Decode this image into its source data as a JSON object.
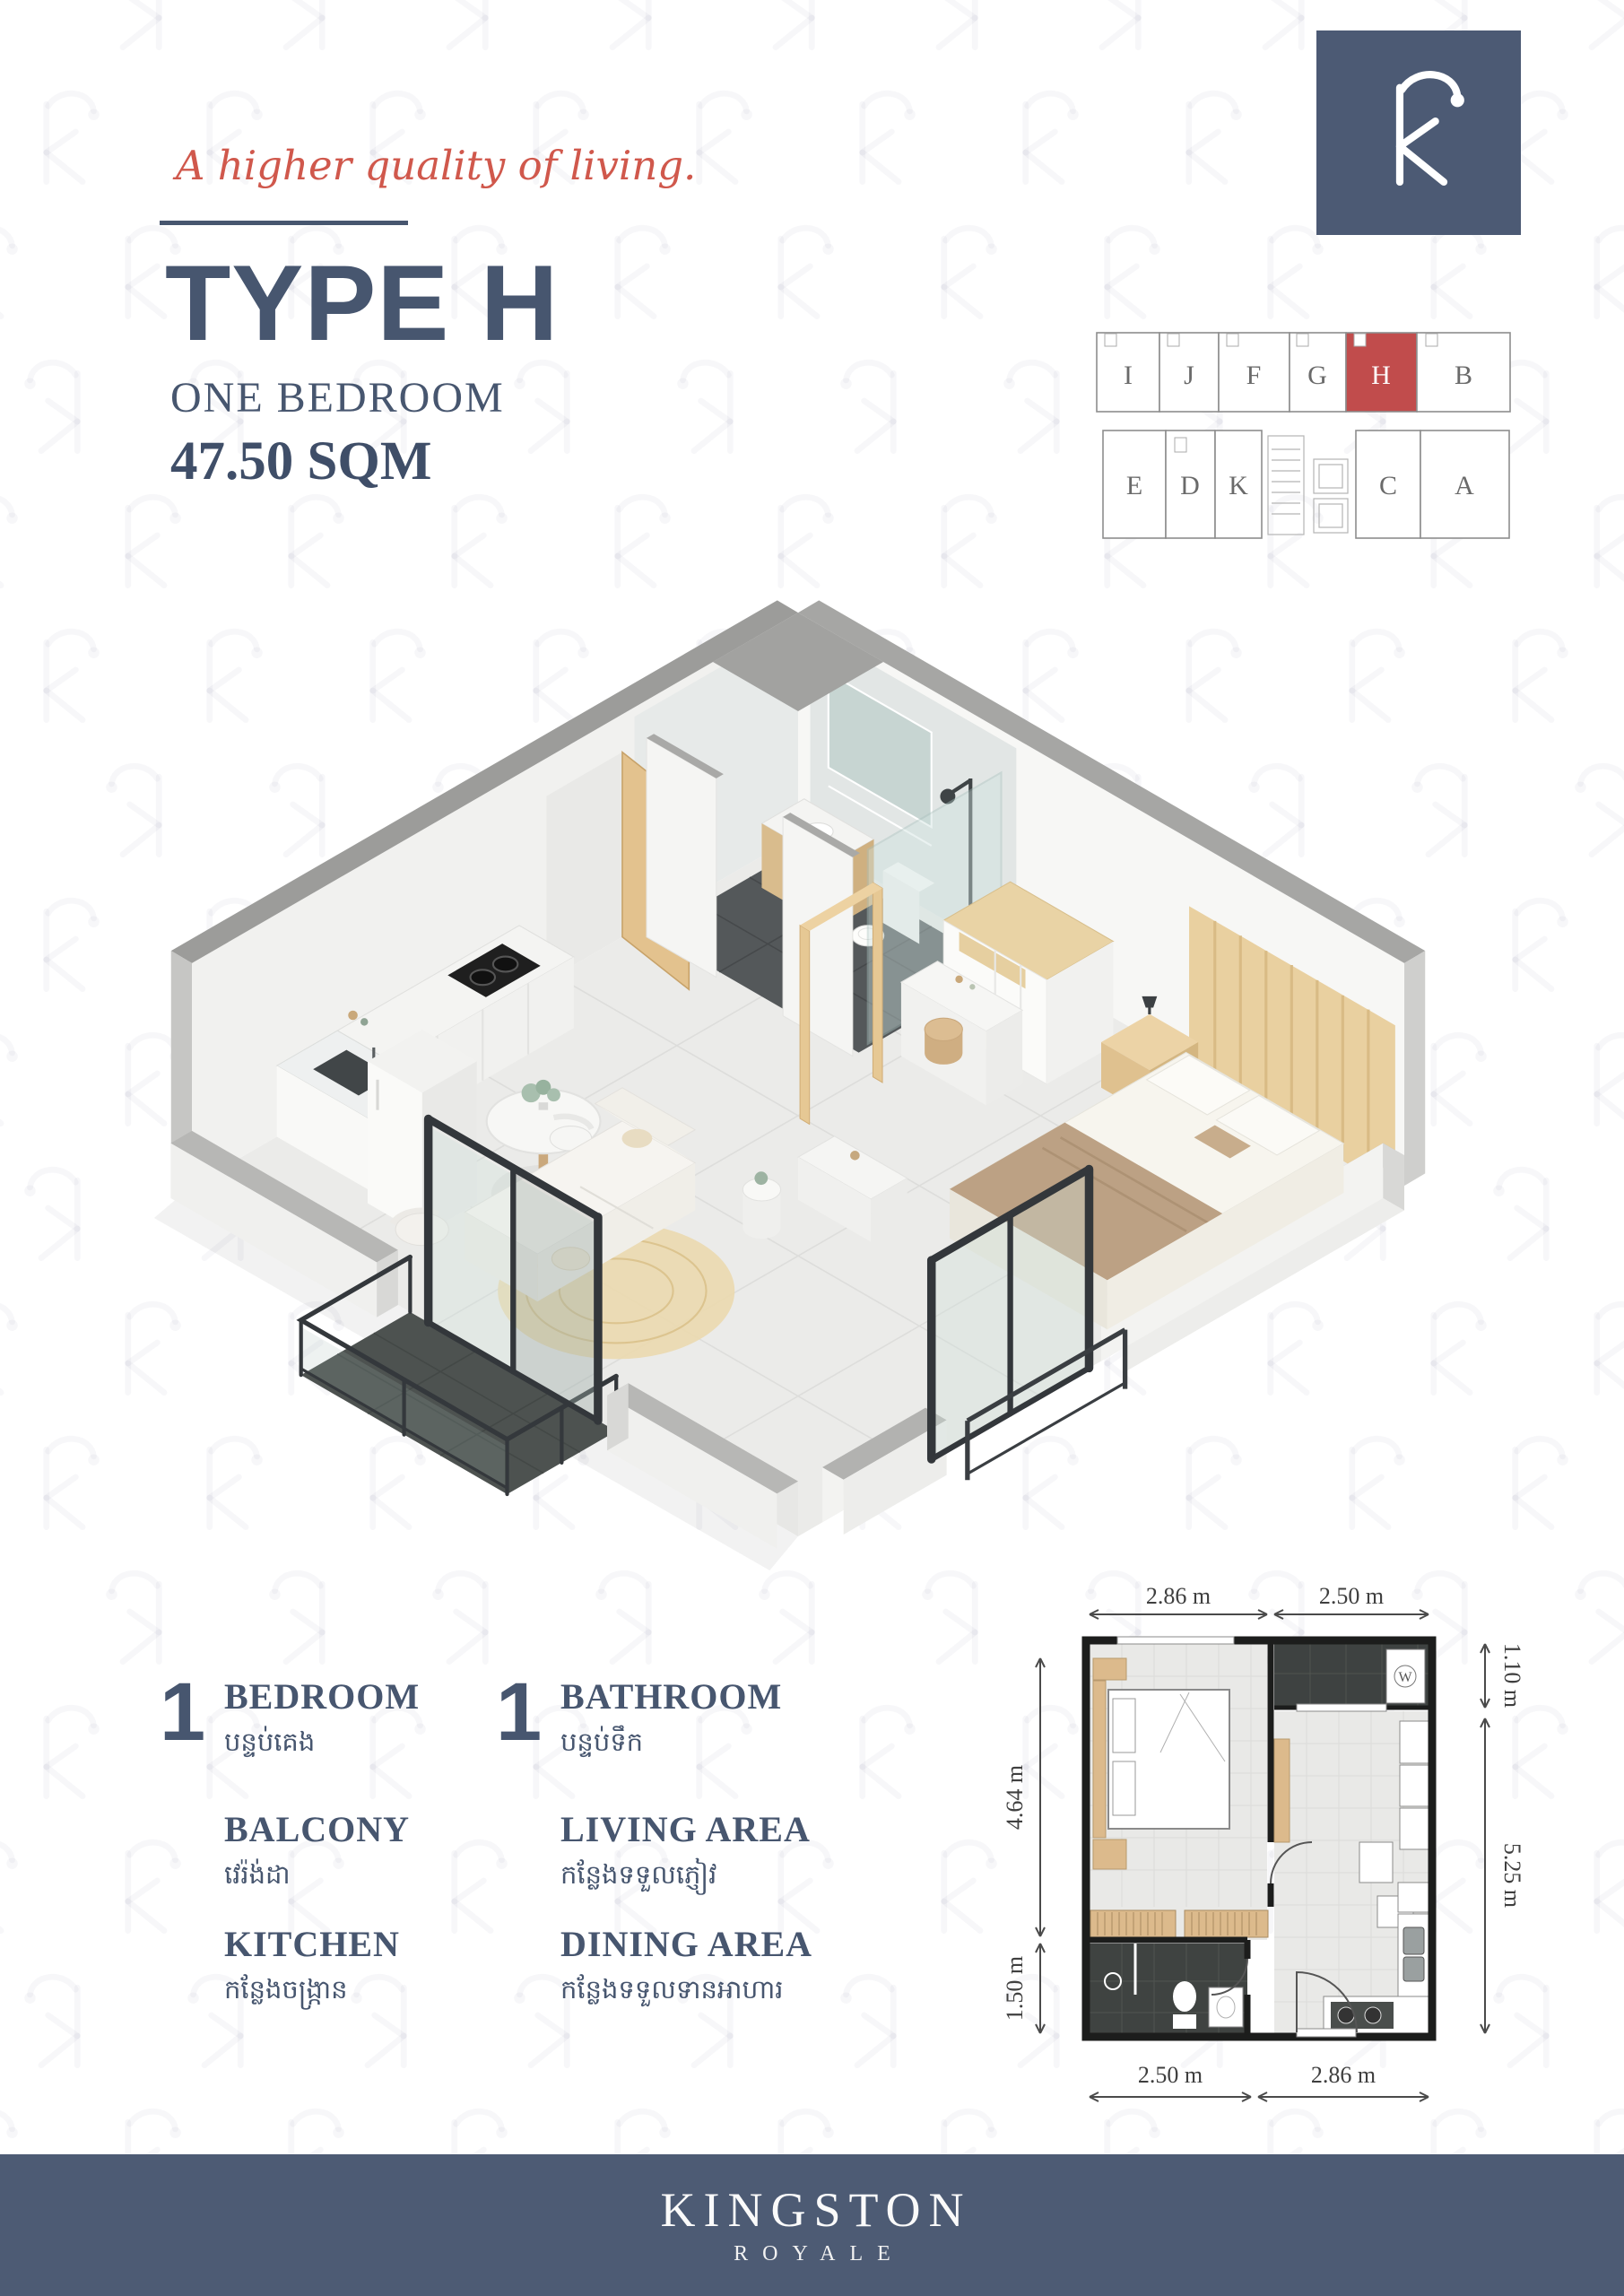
{
  "page": {
    "tagline": "A higher quality of living.",
    "title": "TYPE H",
    "subtitle": "ONE BEDROOM",
    "area": "47.50 SQM"
  },
  "colors": {
    "slate_blue": "#47566f",
    "footer_blue": "#4d5b74",
    "accent_red": "#d0584c",
    "highlight_red": "#c14c4c"
  },
  "icons": {
    "brand_monogram": "k-monogram-icon",
    "watermark": "k-monogram-icon"
  },
  "floorplate": {
    "highlighted_unit": "H",
    "highlight_color": "#c14c4c",
    "top_units": [
      "I",
      "J",
      "F",
      "G",
      "H",
      "B"
    ],
    "bottom_units": [
      "E",
      "D",
      "K",
      "C",
      "A"
    ]
  },
  "features": {
    "items": [
      {
        "count": "1",
        "label": "BEDROOM",
        "khmer": "បន្ទប់គេង"
      },
      {
        "count": "1",
        "label": "BATHROOM",
        "khmer": "បន្ទប់ទឹក"
      },
      {
        "count": "",
        "label": "BALCONY",
        "khmer": "វេរ៉ង់ដា"
      },
      {
        "count": "",
        "label": "LIVING AREA",
        "khmer": "កន្លែងទទួលភ្ញៀវ"
      },
      {
        "count": "",
        "label": "KITCHEN",
        "khmer": "កន្លែងចង្ក្រាន"
      },
      {
        "count": "",
        "label": "DINING AREA",
        "khmer": "កន្លែងទទួលទានអាហារ"
      }
    ]
  },
  "plan2d": {
    "dimensions": {
      "top_left": "2.86 m",
      "top_right": "2.50 m",
      "right_top": "1.10 m",
      "right_bottom": "5.25 m",
      "left_top": "4.64 m",
      "left_bottom": "1.50 m",
      "bottom_left": "2.50 m",
      "bottom_right": "2.86 m"
    },
    "washer_label": "W"
  },
  "footer": {
    "brand": "KINGSTON",
    "sub_brand": "ROYALE"
  }
}
